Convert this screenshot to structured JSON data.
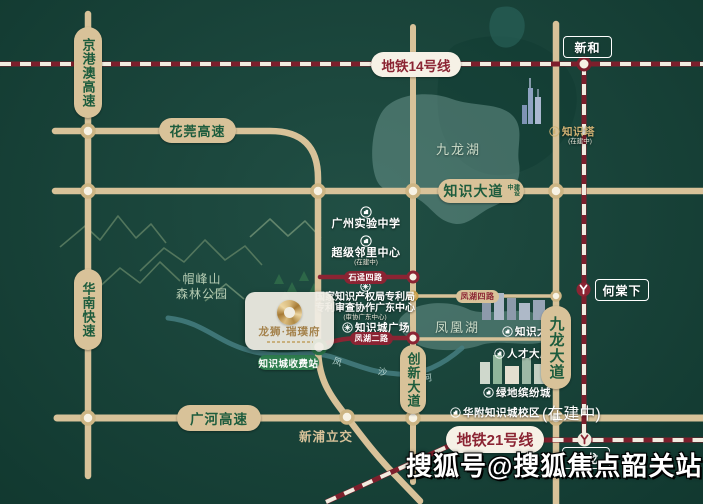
{
  "colors": {
    "background": "#15453a",
    "road_tan": "#d8c299",
    "metro_red": "#8b2433",
    "pill_text_green": "#1d5c3d",
    "gold": "#c9a662",
    "toll_green": "#2e7d4e",
    "lake_teal": "#6f9a92",
    "white": "#ffffff"
  },
  "highways": {
    "jinggangao": "京港澳高速",
    "huanan": "华南快速",
    "huaguan": "花莞高速",
    "guanghe": "广河高速",
    "zhishi_avenue": "知识大道",
    "zhishi_status": "建设中",
    "chuangxin_avenue": "创新大道",
    "jiulong_avenue": "九龙大道",
    "xinpu_interchange": "新浦立交"
  },
  "metro": {
    "line14_label": "地铁14号线",
    "line21_label": "地铁21号线",
    "station_xinhe": "新和",
    "station_hetangxia": "何棠下",
    "station_zhenlong": "镇龙"
  },
  "local_roads": {
    "shijing4": "石迳四路",
    "fenghu2": "凤湖二路",
    "fenghu4": "凤湖四路",
    "toll_station": "知识城收费站"
  },
  "water": {
    "jiulong_lake": "九龙湖",
    "fenghuang_lake": "凤凰湖",
    "river_chars": [
      "凤",
      "沙",
      "河"
    ]
  },
  "park": {
    "name_line1": "帽峰山",
    "name_line2": "森林公园"
  },
  "pois": {
    "experimental_school": {
      "name": "广州实验中学"
    },
    "neighborhood_center": {
      "name": "超级邻里中心",
      "status": "(在建中)"
    },
    "patent_center": {
      "name_line1": "国家知识产权局专利局",
      "name_line2": "专利审查协作广东中心",
      "status": "(审协广东中心)"
    },
    "knowledge_plaza": {
      "name": "知识城广场"
    },
    "knowledge_tower": {
      "name": "知识塔",
      "status": "(在建中)"
    },
    "knowledge_mansion": {
      "name": "知识大厦"
    },
    "talent_mansion": {
      "name": "人才大厦"
    },
    "greenland_mall": {
      "name": "绿地缤纷城"
    },
    "hf_school": {
      "name": "华附知识城校区",
      "status": "(在建中)"
    }
  },
  "project": {
    "logo_name": "龙狮·瑞璞府"
  },
  "watermark": "搜狐号@搜狐焦点韶关站"
}
